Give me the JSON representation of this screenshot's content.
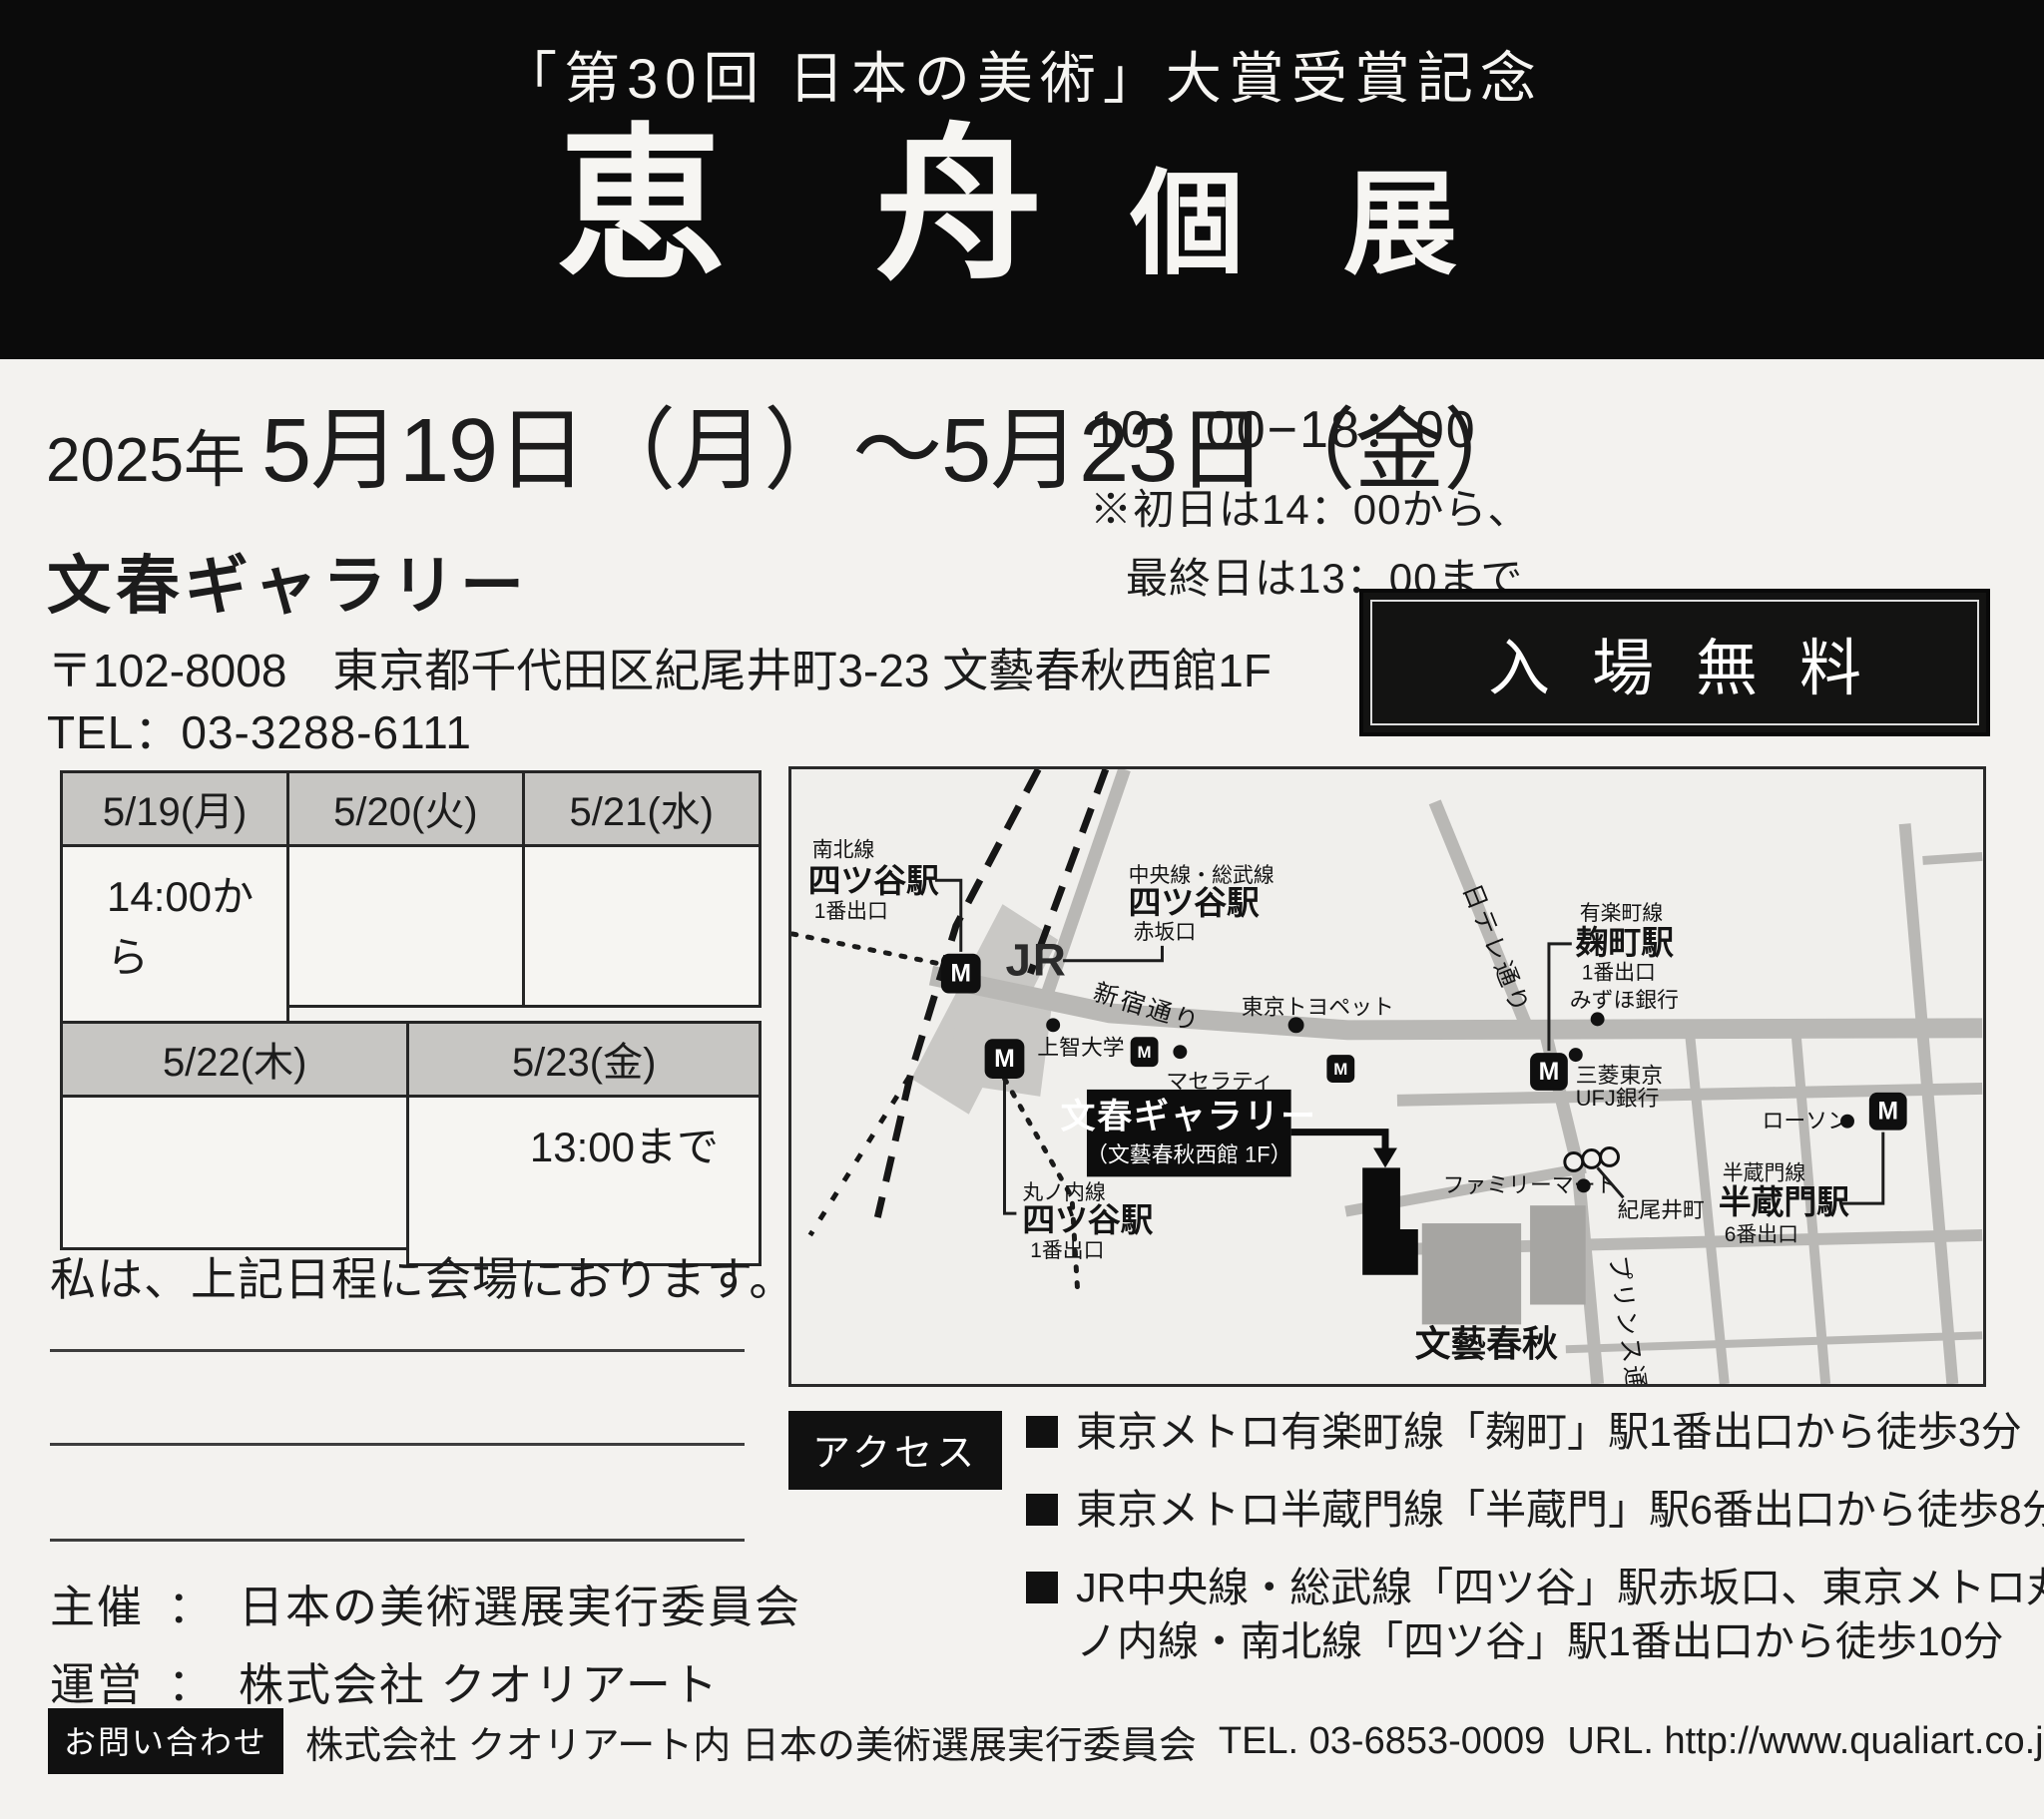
{
  "header": {
    "subtitle": "「第30回 日本の美術」大賞受賞記念",
    "title_main": "恵 舟",
    "title_sub": "個 展"
  },
  "schedule": {
    "year": "2025年",
    "date_range": "5月19日（月）～5月23日（金）",
    "hours": "10：00−18：00",
    "note_line1": "※初日は14：00から、",
    "note_line2": "最終日は13：00まで"
  },
  "venue": {
    "name": "文春ギャラリー",
    "address": "〒102-8008　東京都千代田区紀尾井町3-23 文藝春秋西館1F",
    "tel": "TEL：03-3288-6111",
    "admission": "入場無料"
  },
  "calendar": {
    "row1": {
      "headers": [
        "5/19(月)",
        "5/20(火)",
        "5/21(水)"
      ],
      "values": [
        "14:00から",
        "",
        ""
      ]
    },
    "row2": {
      "headers": [
        "5/22(木)",
        "5/23(金)"
      ],
      "values": [
        "",
        "13:00まで"
      ]
    }
  },
  "presence_note": "私は、上記日程に会場におります。",
  "organizers": {
    "separator": "：",
    "rows": [
      {
        "label": "主催",
        "value": "日本の美術選展実行委員会"
      },
      {
        "label": "運営",
        "value": "株式会社 クオリアート"
      }
    ]
  },
  "access": {
    "badge": "アクセス",
    "items": [
      "東京メトロ有楽町線「麹町」駅1番出口から徒歩3分",
      "東京メトロ半蔵門線「半蔵門」駅6番出口から徒歩8分",
      "JR中央線・総武線「四ツ谷」駅赤坂口、東京メトロ丸ノ内線・南北線「四ツ谷」駅1番出口から徒歩10分"
    ]
  },
  "contact": {
    "badge": "お問い合わせ",
    "text": "株式会社 クオリアート内 日本の美術選展実行委員会",
    "tel": "TEL. 03-6853-0009",
    "url": "URL. http://www.qualiart.co.jp"
  },
  "map": {
    "metro_logo_letter": "M",
    "jr_logo": "JR",
    "stations": {
      "nanboku": {
        "line": "南北線",
        "name": "四ツ谷駅",
        "exit": "1番出口"
      },
      "chuo_sobu": {
        "line": "中央線・総武線",
        "name": "四ツ谷駅",
        "exit": "赤坂口"
      },
      "marunouchi": {
        "line": "丸ノ内線",
        "name": "四ツ谷駅",
        "exit": "1番出口"
      },
      "yurakucho": {
        "line": "有楽町線",
        "name": "麹町駅",
        "exit": "1番出口"
      },
      "hanzomon": {
        "line": "半蔵門線",
        "name": "半蔵門駅",
        "exit": "6番出口"
      }
    },
    "venue_label": {
      "name": "文春ギャラリー",
      "sub": "（文藝春秋西館 1F）"
    },
    "streets": {
      "shinjuku_dori": "新宿通り",
      "nittele_dori": "日テレ通り",
      "prince_dori": "プリンス通り",
      "kioicho": "紀尾井町"
    },
    "landmarks": {
      "sophia": "上智大学",
      "maserati": "マセラティ",
      "toyopet": "東京トヨペット",
      "mizuho": "みずほ銀行",
      "mufg_line1": "三菱東京",
      "mufg_line2": "UFJ銀行",
      "lawson": "ローソン",
      "familymart": "ファミリーマート",
      "bungeishunju": "文藝春秋"
    }
  },
  "colors": {
    "band": "#0b0b0b",
    "ink": "#1c1c1c",
    "paper": "#f3f2ef"
  }
}
